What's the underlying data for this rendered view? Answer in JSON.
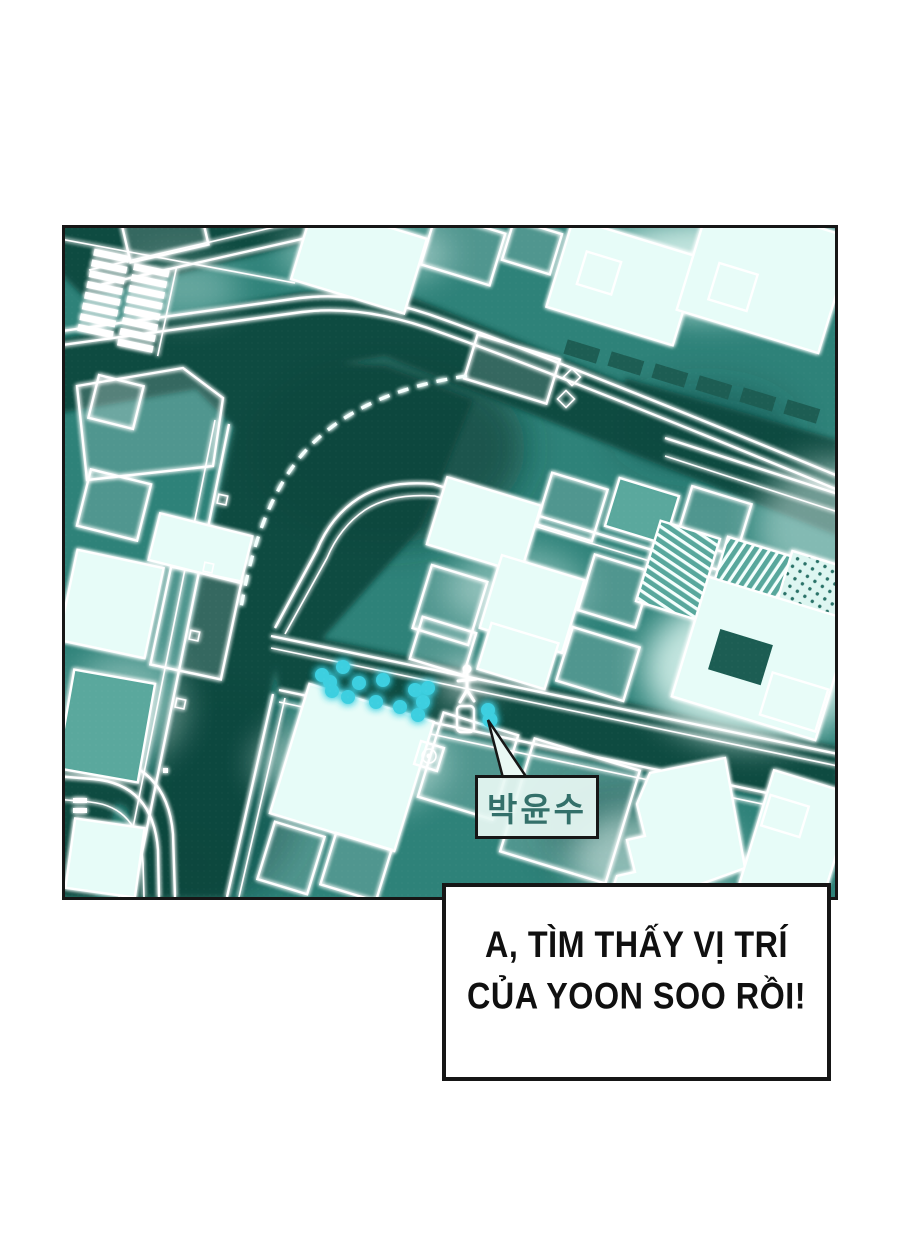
{
  "comic": {
    "map_label": "박윤수",
    "dialogue": {
      "line1": "A, TÌM THẤY VỊ TRÍ",
      "line2": "CỦA YOON SOO RỒI!"
    },
    "colors": {
      "page_bg": "#ffffff",
      "panel_border": "#161616",
      "map_base": "#2e8279",
      "road_dark": "#11463d",
      "glow_line": "#ffffff",
      "bright_building": "#e7fcf8",
      "tracking_dot": "#3ecfe0",
      "label_text": "#33706a",
      "dialogue_text": "#101010"
    },
    "icons": {
      "person_marker": "person-marker-icon",
      "tracking_dots": "tracking-dots",
      "route": "route-dashed-line",
      "road_diamonds": "road-diamond-markers"
    }
  }
}
